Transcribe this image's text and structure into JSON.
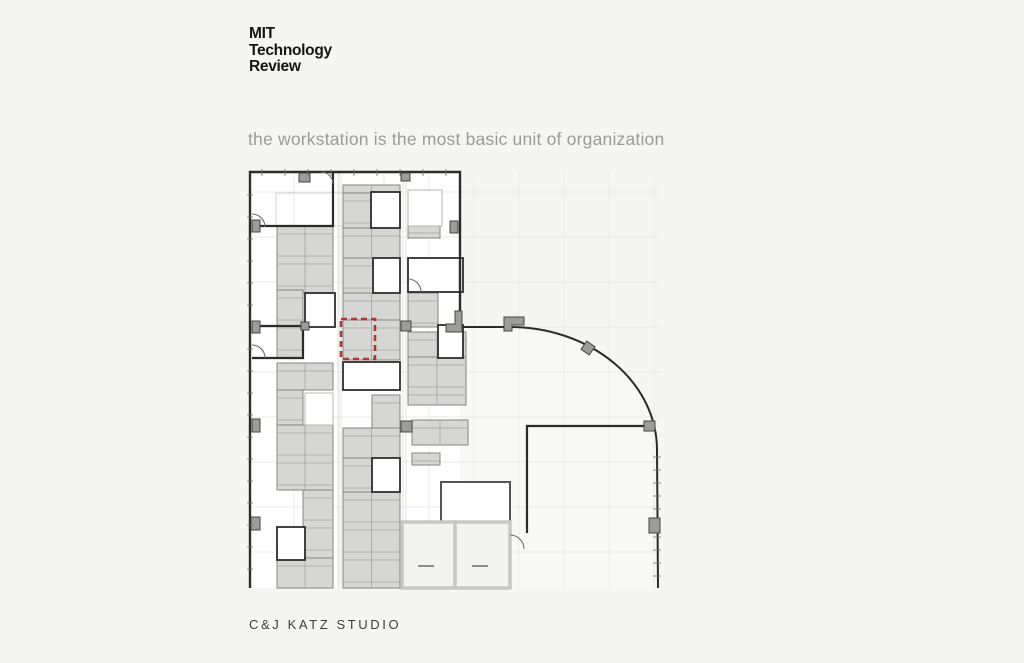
{
  "slide": {
    "background": "#f5f5f4",
    "logo": {
      "lines": [
        "MIT",
        "Technology",
        "Review"
      ],
      "color": "#151515"
    },
    "caption": {
      "text": "the workstation is the most basic unit of organization",
      "color": "#9b9b9b"
    },
    "footer": {
      "text": "C&J KATZ STUDIO",
      "color": "#3d3d3d"
    }
  },
  "plan": {
    "colors": {
      "wall": "#2b2b2b",
      "deskFill": "#d6d6d4",
      "deskStroke": "#858583",
      "deskLine": "#a3a3a1",
      "grid": "#e9e9e5",
      "corridor": "#dededa",
      "towerFill": "#fefefe",
      "wingFill": "#f8f8f6",
      "roomFill": "#ffffff",
      "roomStroke": "#2e2e2e",
      "lightStroke": "#b8b8b4",
      "colFill": "#9c9c9a",
      "colStroke": "#454543",
      "coreStroke": "#c7c7c3",
      "coreFill": "#f3f3f1",
      "doorStroke": "#6b6b69",
      "tick": "#6f6f6d",
      "faint": "#dcd3d1",
      "highlight": "#a83a33"
    },
    "grid": {
      "vxs": [
        294,
        339,
        384,
        429,
        474,
        519,
        564,
        609,
        654
      ],
      "hys": [
        192,
        237,
        282,
        327,
        372,
        417,
        462,
        507,
        552
      ],
      "x1": 248,
      "x2": 660,
      "y1": 170,
      "y2": 588
    },
    "tower": {
      "x": 250,
      "y": 172,
      "w": 210,
      "h": 416
    },
    "wing_path": "M460,327 L510,327 A147,123 0 0 1 657,450 L658,588 L460,588 Z",
    "corridors": [
      338,
      341,
      403,
      406
    ],
    "clusters": [
      [
        277,
        226,
        56,
        67,
        1
      ],
      [
        277,
        290,
        26,
        68,
        0
      ],
      [
        277,
        363,
        56,
        27,
        1
      ],
      [
        277,
        390,
        26,
        35,
        0
      ],
      [
        277,
        425,
        56,
        65,
        1
      ],
      [
        303,
        490,
        30,
        70,
        0
      ],
      [
        277,
        558,
        56,
        30,
        1
      ],
      [
        343,
        185,
        57,
        8,
        1
      ],
      [
        343,
        193,
        28,
        35,
        0
      ],
      [
        343,
        228,
        57,
        30,
        1
      ],
      [
        343,
        258,
        30,
        35,
        0
      ],
      [
        343,
        293,
        57,
        27,
        1
      ],
      [
        343,
        320,
        57,
        40,
        1
      ],
      [
        343,
        383,
        29,
        7,
        0
      ],
      [
        372,
        395,
        28,
        33,
        0
      ],
      [
        343,
        428,
        57,
        30,
        1
      ],
      [
        343,
        458,
        29,
        34,
        0
      ],
      [
        343,
        492,
        57,
        96,
        1
      ],
      [
        408,
        225,
        32,
        13,
        0
      ],
      [
        408,
        293,
        30,
        34,
        0
      ],
      [
        408,
        332,
        58,
        25,
        1
      ],
      [
        408,
        357,
        58,
        48,
        1
      ],
      [
        412,
        420,
        56,
        25,
        1
      ],
      [
        412,
        453,
        28,
        12,
        0
      ]
    ],
    "rooms_bold": [
      [
        371,
        192,
        29,
        36
      ],
      [
        373,
        258,
        27,
        35
      ],
      [
        408,
        258,
        55,
        34
      ],
      [
        438,
        325,
        25,
        33
      ],
      [
        305,
        293,
        30,
        34
      ],
      [
        343,
        362,
        57,
        28
      ],
      [
        372,
        458,
        28,
        34
      ],
      [
        277,
        527,
        28,
        33
      ]
    ],
    "room_outline": [
      441,
      482,
      69,
      41
    ],
    "rooms_light": [
      [
        305,
        393,
        28,
        32
      ],
      [
        408,
        190,
        34,
        36
      ]
    ],
    "faint_rects": [
      [
        276,
        193,
        74,
        33
      ]
    ],
    "walls": [
      {
        "d": "M250,588 L250,172 L460,172 L460,330",
        "w": 2.4
      },
      {
        "d": "M460,327 L510,327",
        "w": 2
      },
      {
        "d": "M510,327 A147,123 0 0 1 657,450 L658,588",
        "w": 2
      },
      {
        "d": "M527,533 L527,426 L648,426",
        "w": 2.2
      },
      {
        "d": "M252,326 L307,326",
        "w": 2.2
      },
      {
        "d": "M252,226 L333,226 L333,172",
        "w": 2.2
      },
      {
        "d": "M252,358 L303,358 L303,327",
        "w": 2.2
      }
    ],
    "pilasters": [
      "M455,311 L462,311 L462,332 L446,332 L446,324 L455,324 Z",
      "M504,317 L524,317 L524,325 L512,325 L512,331 L504,331 Z"
    ],
    "columns": [
      [
        299,
        173,
        11,
        9
      ],
      [
        401,
        173,
        9,
        8
      ],
      [
        252,
        220,
        8,
        12
      ],
      [
        450,
        221,
        8,
        12
      ],
      [
        252,
        321,
        8,
        12
      ],
      [
        301,
        322,
        8,
        8
      ],
      [
        401,
        321,
        10,
        10
      ],
      [
        252,
        419,
        8,
        13
      ],
      [
        401,
        421,
        11,
        11
      ],
      [
        251,
        517,
        9,
        13
      ],
      [
        644,
        421,
        11,
        10
      ],
      [
        649,
        518,
        11,
        15
      ]
    ],
    "column_rot": {
      "x": 583,
      "y": 343,
      "w": 10,
      "h": 10,
      "r": 35
    },
    "doors": [
      "M321,172 A12,12 0 0 1 333,184",
      "M252,345 A13,13 0 0 1 265,358",
      "M408,279 A13,13 0 0 1 421,292",
      "M265,227 A13,13 0 0 0 252,214",
      "M510,535 A14,14 0 0 1 524,549"
    ],
    "ticks": {
      "top": {
        "y1": 169,
        "y2": 176,
        "xs": [
          262,
          285,
          308,
          331,
          354,
          377,
          400,
          423,
          446
        ]
      },
      "left": {
        "x1": 247,
        "x2": 253,
        "ys": [
          195,
          217,
          239,
          261,
          283,
          305,
          349,
          371,
          393,
          415,
          437,
          459,
          481,
          503,
          525,
          547,
          569
        ]
      },
      "right": {
        "x1": 653,
        "x2": 661,
        "ys": [
          457,
          470,
          483,
          496,
          509,
          537,
          550,
          563,
          576
        ]
      }
    },
    "core": {
      "cells": [
        [
          402,
          522,
          53,
          66
        ],
        [
          455,
          522,
          55,
          66
        ]
      ],
      "stubs": [
        "M418,566 L434,566",
        "M472,566 L488,566"
      ]
    },
    "highlight": {
      "x": 341,
      "y": 319,
      "w": 34,
      "h": 40,
      "dash": "6 4",
      "stroke_w": 2.6
    }
  }
}
